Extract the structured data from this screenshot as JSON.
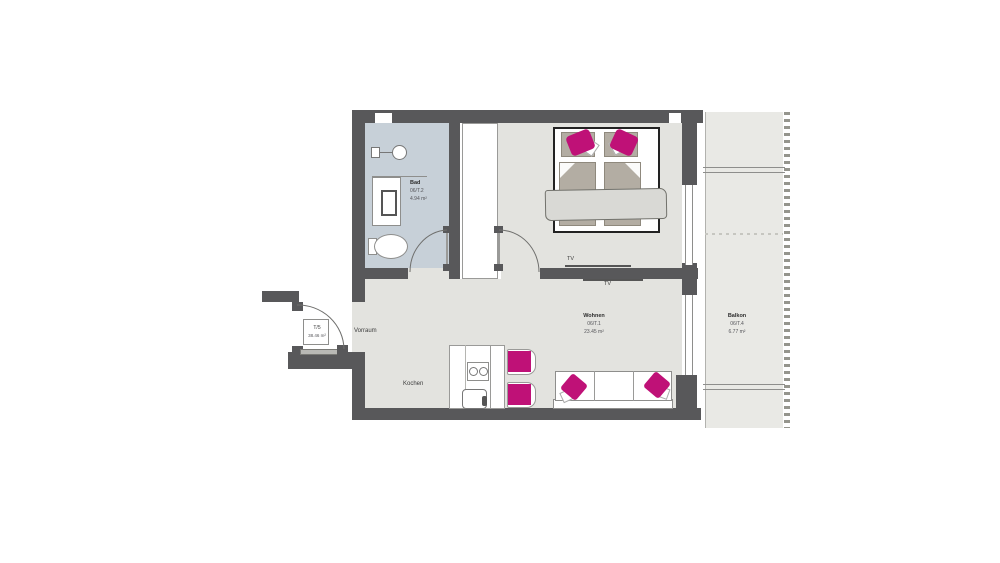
{
  "rooms": {
    "bad": {
      "name": "Bad",
      "unit": "06/T.2",
      "area": "4.94 m²"
    },
    "wohnen": {
      "name": "Wohnen",
      "unit": "06/T.1",
      "area": "23.45 m²"
    },
    "balkon": {
      "name": "Balkon",
      "unit": "06/T.4",
      "area": "6.77 m²"
    },
    "vorraum": {
      "name": "Vorraum"
    },
    "kochen": {
      "name": "Kochen"
    }
  },
  "labels": {
    "tv_bedroom": "TV",
    "tv_living": "TV"
  },
  "entry_tag": {
    "unit": "T/5",
    "area": "38.46 m²"
  },
  "colors": {
    "wall": "#58585a",
    "floor": "#e3e3df",
    "bathroom_floor": "#c7d0d8",
    "balcony_floor": "#e9e9e5",
    "accent_pink": "#bf1177",
    "textile_beige": "#b3ada3",
    "blanket_gray": "#d9d9d5"
  }
}
